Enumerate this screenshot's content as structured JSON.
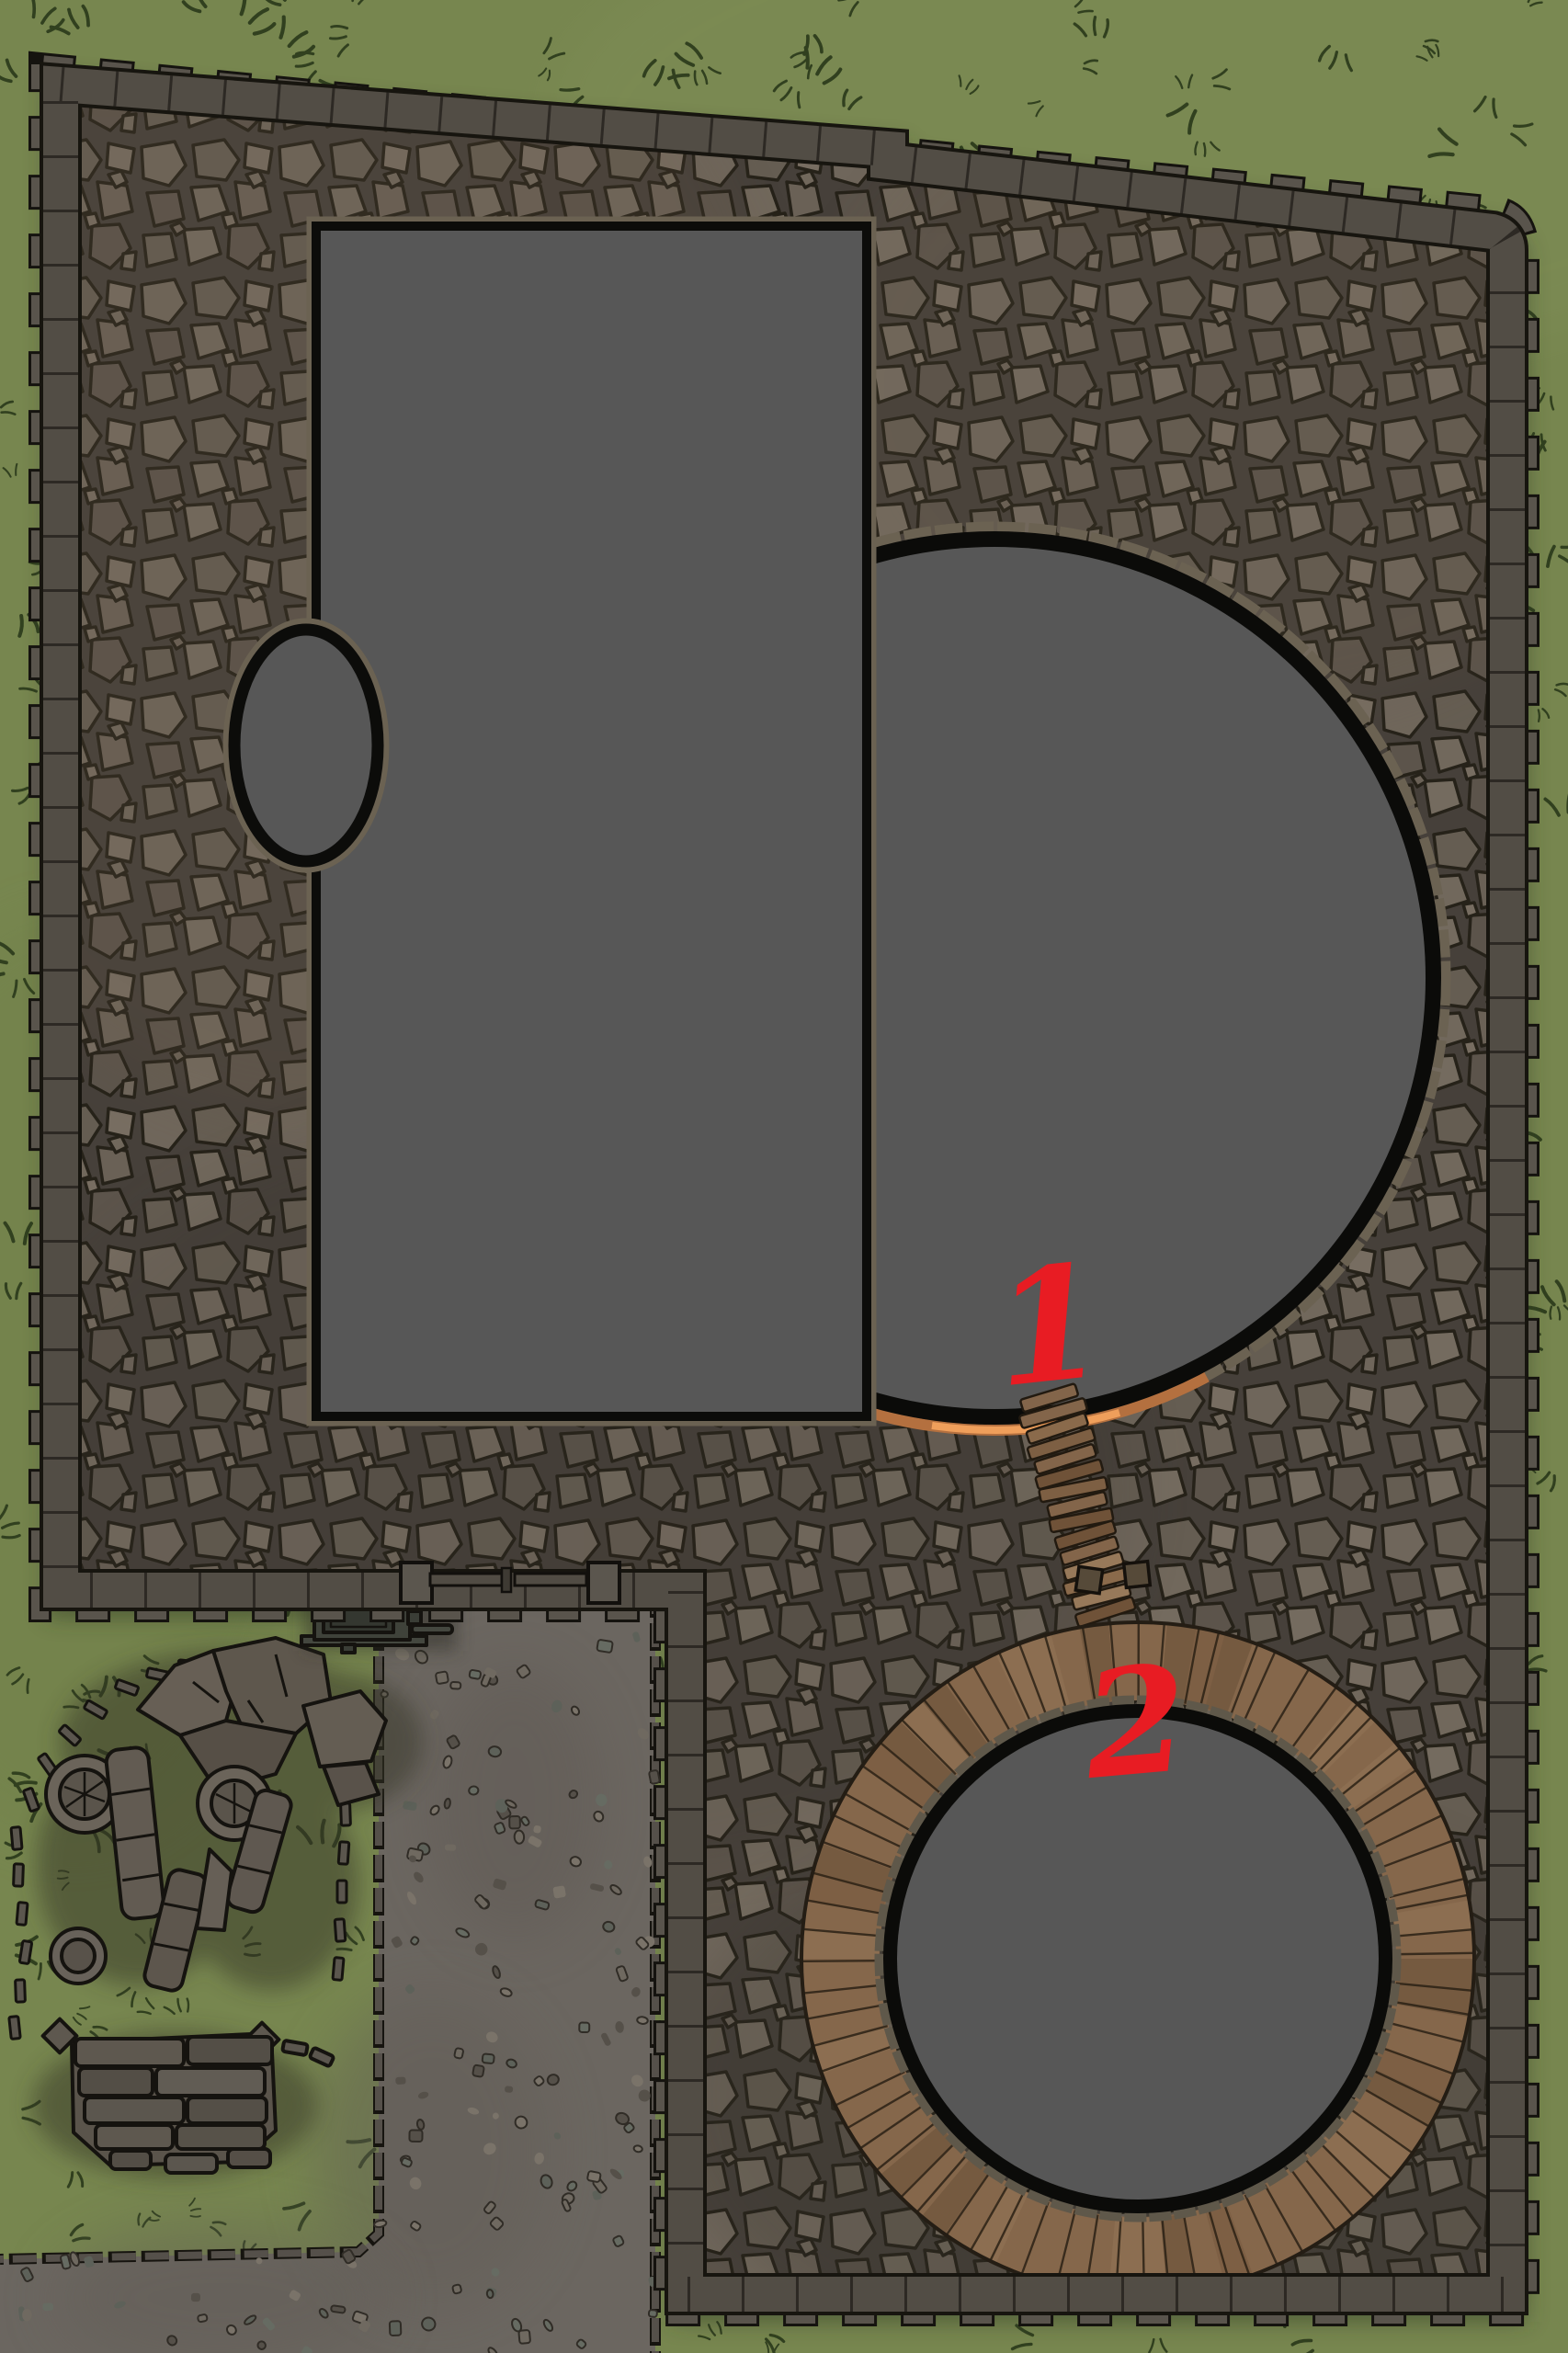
{
  "map": {
    "type": "top-down battle map",
    "annotations": [
      {
        "label": "1"
      },
      {
        "label": "2"
      }
    ],
    "colors": {
      "grass": "#77864f",
      "cobblestone": "#46403a",
      "wall": "#524d45",
      "roof": "#575757",
      "wood": "#85674b",
      "gravel": "#6b6660",
      "annotation": "#e81c23",
      "outline": "#0c0c0a",
      "stone_ledge": "#6b6252"
    },
    "features": [
      "perimeter-wall",
      "cobblestone-courtyard",
      "large-building-roof",
      "round-tower-roof",
      "small-round-tower-roof",
      "side-turret-roof",
      "wooden-boardwalk",
      "plank-bridge",
      "south-gate",
      "gravel-path",
      "hand-cart",
      "ruined-colonnade",
      "broken-wall",
      "grass-field"
    ]
  }
}
